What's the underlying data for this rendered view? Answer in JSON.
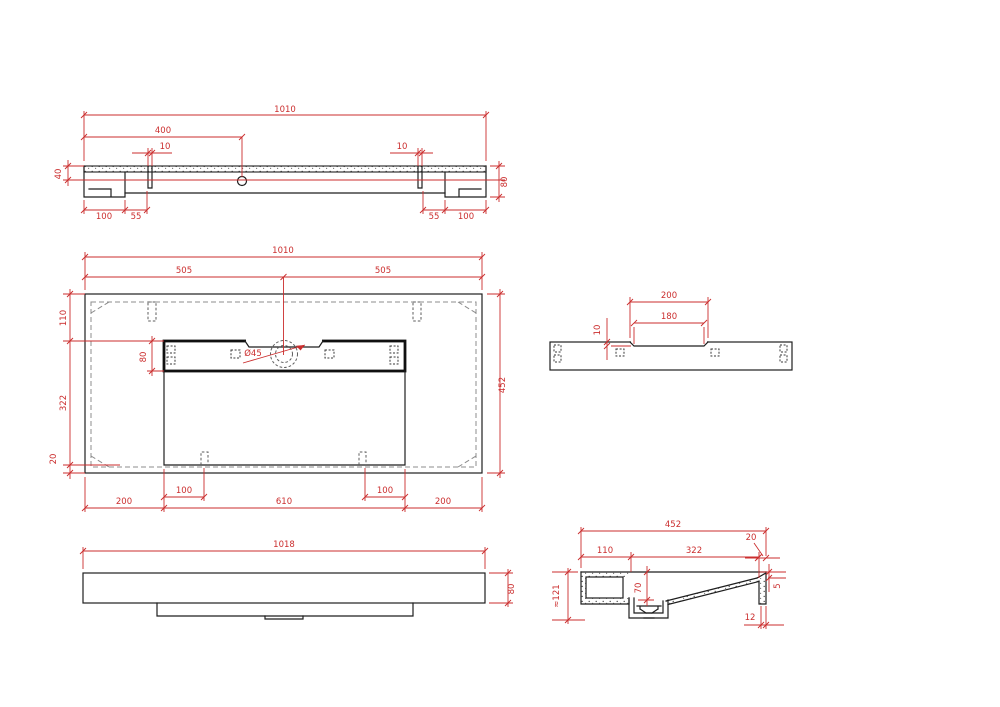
{
  "drawing": {
    "title": "washbasin-technical-drawing",
    "colors": {
      "background": "#ffffff",
      "geometry": "#1e1e1e",
      "dashed": "#8c8c8c",
      "dimension": "#cb2e2e"
    },
    "views": {
      "top_section": {
        "dims": {
          "overall": "1010",
          "hole_offset": "400",
          "slot_left": "10",
          "slot_right": "10",
          "edge_height": "40",
          "total_height": "80",
          "left_100": "100",
          "left_55": "55",
          "right_55": "55",
          "right_100": "100"
        }
      },
      "plan": {
        "dims": {
          "overall": "1010",
          "half_left": "505",
          "half_right": "505",
          "top_inset": "110",
          "deck_width": "80",
          "bowl_depth": "322",
          "bottom_inset": "20",
          "overall_depth": "452",
          "drain_dia": "Ø45",
          "left_200": "200",
          "left_100": "100",
          "bowl_width": "610",
          "right_100": "100",
          "right_200": "200"
        }
      },
      "deck_side": {
        "dims": {
          "recess_outer": "200",
          "recess_inner": "180",
          "recess_depth": "10"
        }
      },
      "front": {
        "dims": {
          "overall": "1018",
          "height": "80"
        }
      },
      "side_section": {
        "dims": {
          "overall": "452",
          "back_width": "110",
          "slope_width": "322",
          "top_wall": "20",
          "sump_depth": "70",
          "front_lip": "5",
          "bottom_wall": "12",
          "total_height": "≈121"
        }
      }
    }
  }
}
